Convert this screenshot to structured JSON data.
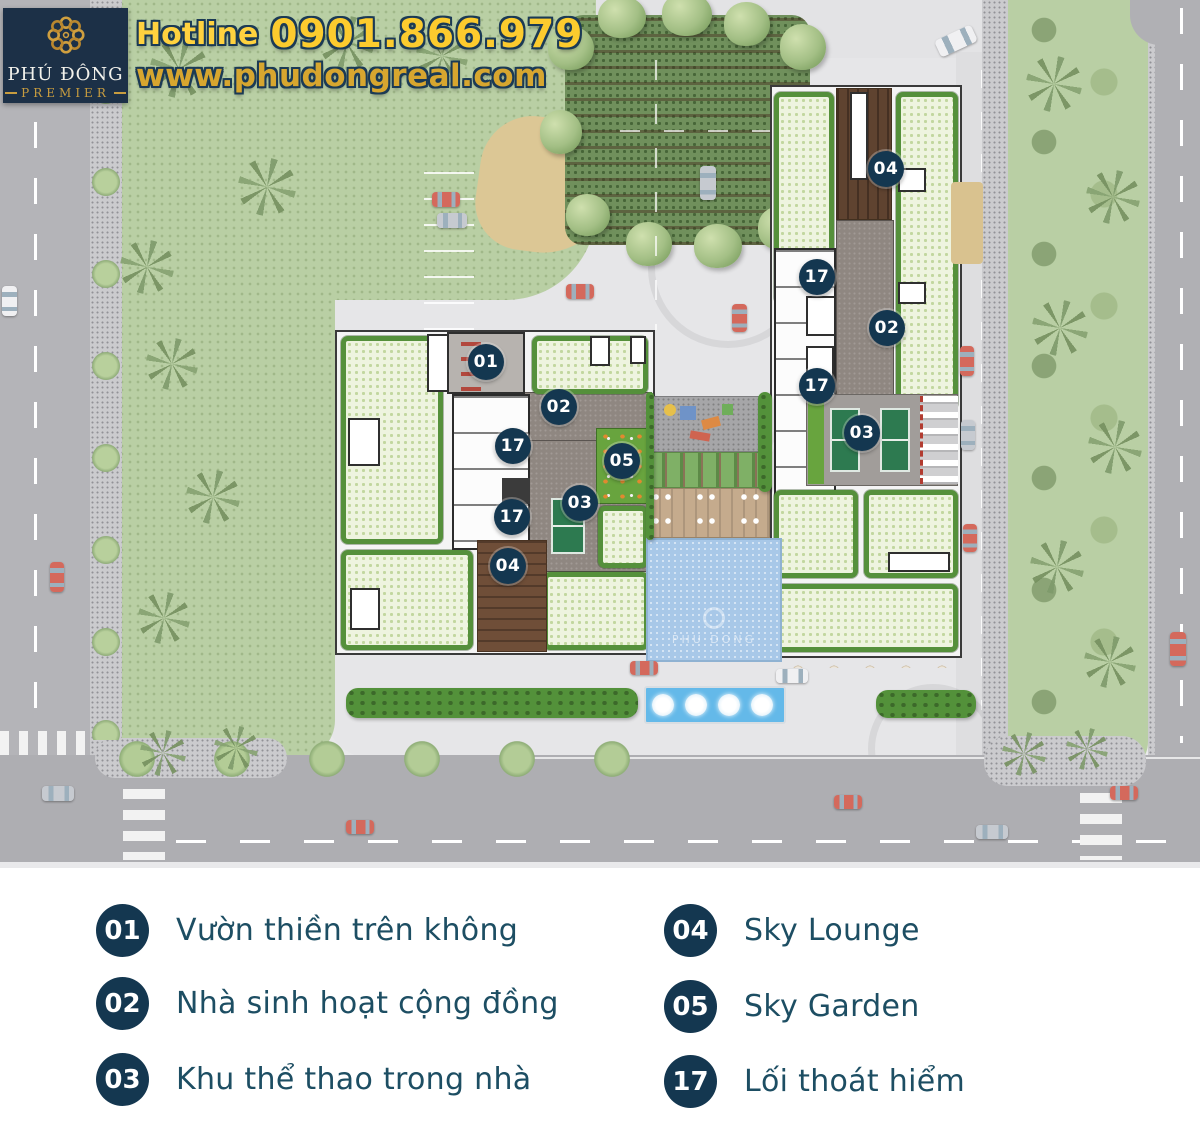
{
  "header": {
    "logo": {
      "line1": "PHÚ ĐÔNG",
      "line2": "PREMIER"
    },
    "hotline_label": "Hotline",
    "hotline_number": "0901.866.979",
    "website": "www.phudongreal.com"
  },
  "map": {
    "pool_watermark": "PHU DONG",
    "badges": [
      {
        "label": "01"
      },
      {
        "label": "02"
      },
      {
        "label": "17"
      },
      {
        "label": "05"
      },
      {
        "label": "03"
      },
      {
        "label": "17"
      },
      {
        "label": "04"
      },
      {
        "label": "04"
      },
      {
        "label": "17"
      },
      {
        "label": "02"
      },
      {
        "label": "17"
      },
      {
        "label": "03"
      }
    ]
  },
  "legend": {
    "items": [
      {
        "number": "01",
        "label": "Vườn thiền trên không"
      },
      {
        "number": "02",
        "label": "Nhà sinh hoạt cộng đồng"
      },
      {
        "number": "03",
        "label": "Khu thể thao trong nhà"
      },
      {
        "number": "04",
        "label": "Sky Lounge"
      },
      {
        "number": "05",
        "label": "Sky Garden"
      },
      {
        "number": "17",
        "label": "Lối thoát hiểm"
      }
    ]
  },
  "colors": {
    "badge_navy": "#143750",
    "legend_text": "#1d4e63",
    "hotline_yellow": "#ffd23f",
    "website_gold": "#d7a62f",
    "logo_navy": "#1c3047",
    "grass_green": "#b9cfa4",
    "pool_blue": "#a8c8e8",
    "fountain_blue": "#64b9e9",
    "court_green": "#2d7a50",
    "deck_brown": "#6f4e38"
  }
}
